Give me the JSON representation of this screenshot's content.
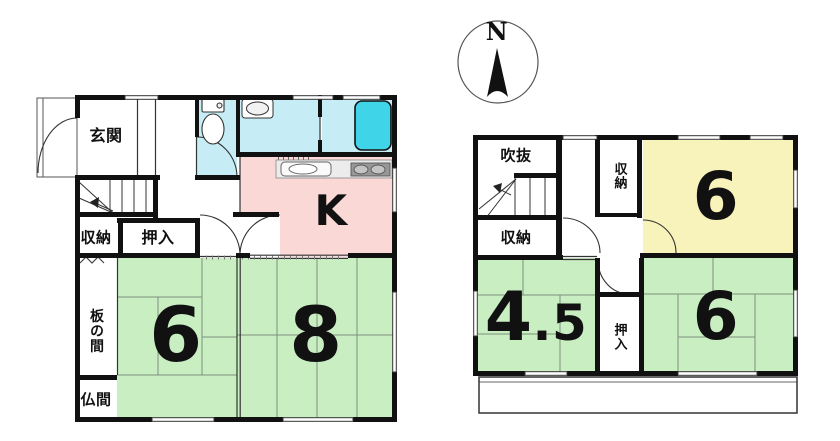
{
  "compass": {
    "north_label": "N"
  },
  "colors": {
    "tatami": "#c9eec2",
    "western": "#f8f3ba",
    "kitchen": "#f9d8d5",
    "wet": "#c6edf6",
    "bathtub": "#3fd4e8",
    "wall": "#111111"
  },
  "floor1": {
    "entrance_label": "玄関",
    "storage_label": "収納",
    "closet_label": "押入",
    "wood_floor_room_label": "板の間",
    "altar_room_label": "仏間",
    "kitchen_label": "K",
    "tatami_room_6_label": "6",
    "tatami_room_8_label": "8"
  },
  "floor2": {
    "atrium_label": "吹抜",
    "storage_left_label": "収納",
    "storage_center_label": "収納",
    "western_room_6_label": "6",
    "tatami_room_45_whole": "4",
    "tatami_room_45_fraction": ".5",
    "closet_label": "押入",
    "tatami_room_6_label": "6"
  }
}
